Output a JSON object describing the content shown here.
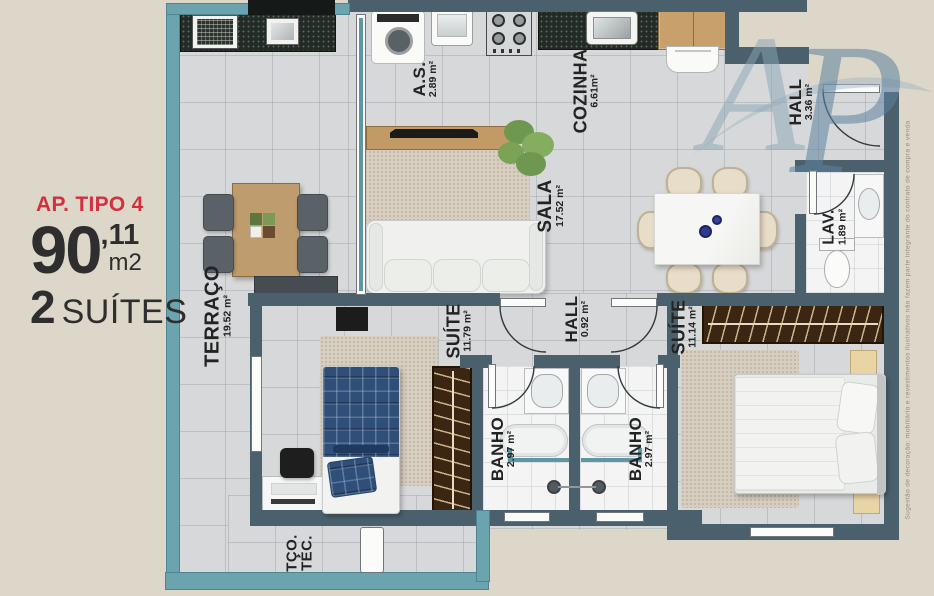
{
  "info_panel": {
    "type_label": "AP. TIPO 4",
    "area_value": "90",
    "area_decimal": ",11",
    "area_unit": "m2",
    "suites_number": "2",
    "suites_word": "SUÍTES"
  },
  "watermark": {
    "letter_a": "A",
    "letter_p": "P"
  },
  "disclaimer": "Sugestão de decoração: mobiliário e revestimentos ilustrativos não fazem parte integrante do contrato de compra e venda",
  "rooms": {
    "terraco": {
      "name": "TERRAÇO",
      "area": "19.52 m²"
    },
    "servico": {
      "name": "A.S.",
      "area": "2.89 m²"
    },
    "cozinha": {
      "name": "COZINHA",
      "area": "6.61m²"
    },
    "hall_entrada": {
      "name": "HALL",
      "area": "3.36 m²"
    },
    "sala": {
      "name": "SALA",
      "area": "17.52 m²"
    },
    "lavabo": {
      "name": "LAV.",
      "area": "1.89 m²"
    },
    "suite1": {
      "name": "SUÍTE",
      "area": "11.79 m²"
    },
    "hall_intimo": {
      "name": "HALL",
      "area": "0.92 m²"
    },
    "suite2": {
      "name": "SUÍTE",
      "area": "11.14 m²"
    },
    "banho1": {
      "name": "BANHO",
      "area": "2.97 m²"
    },
    "banho2": {
      "name": "BANHO",
      "area": "2.97 m²"
    },
    "terraco_tecnico": {
      "name": "TÇO.",
      "line2": "TÉC."
    }
  },
  "colors": {
    "wall": "#4a616d",
    "railing": "#6ba3af",
    "accent_red": "#d2303e",
    "floor": "#d6d8d9",
    "background": "#dcd7c9"
  }
}
